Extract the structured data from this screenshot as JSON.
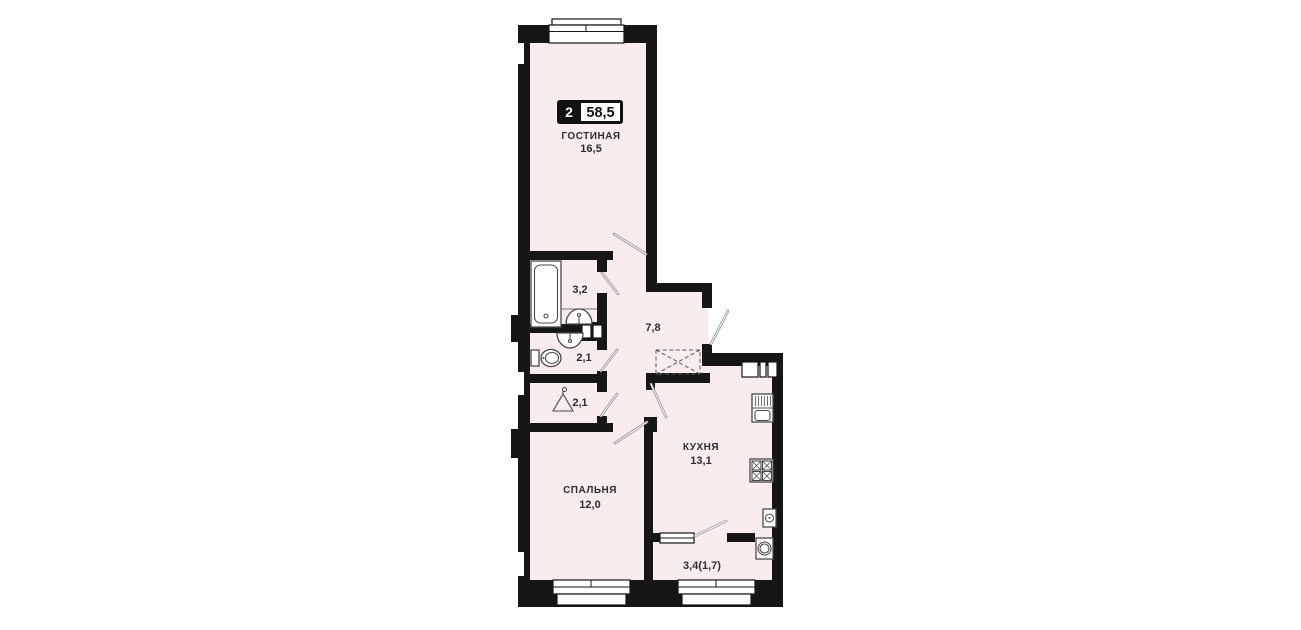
{
  "plan": {
    "badge": {
      "room_count": "2",
      "total_area": "58,5"
    },
    "rooms": [
      {
        "key": "living-room",
        "label": "ГОСТИНАЯ",
        "area": "16,5"
      },
      {
        "key": "bathroom",
        "label": "",
        "area": "3,2"
      },
      {
        "key": "hallway",
        "label": "",
        "area": "7,8"
      },
      {
        "key": "wc",
        "label": "",
        "area": "2,1"
      },
      {
        "key": "closet",
        "label": "",
        "area": "2,1"
      },
      {
        "key": "bedroom",
        "label": "СПАЛЬНЯ",
        "area": "12,0"
      },
      {
        "key": "kitchen",
        "label": "КУХНЯ",
        "area": "13,1"
      },
      {
        "key": "balcony",
        "label": "",
        "area": "3,4(1,7)"
      }
    ],
    "fixtures": [
      "bathtub",
      "sink-bathroom",
      "sink-wc",
      "toilet",
      "hanger",
      "built-in-wardrobe",
      "vent-shaft",
      "kitchen-sink",
      "stove",
      "water-heater",
      "washing-machine"
    ],
    "colors": {
      "wall": "#161616",
      "room_fill": "#f8ecec",
      "door_line": "#8f8f8f",
      "fixture_line": "#4a4a4a",
      "text": "#2e2e2e",
      "badge_bg": "#111111",
      "background": "#ffffff"
    }
  }
}
